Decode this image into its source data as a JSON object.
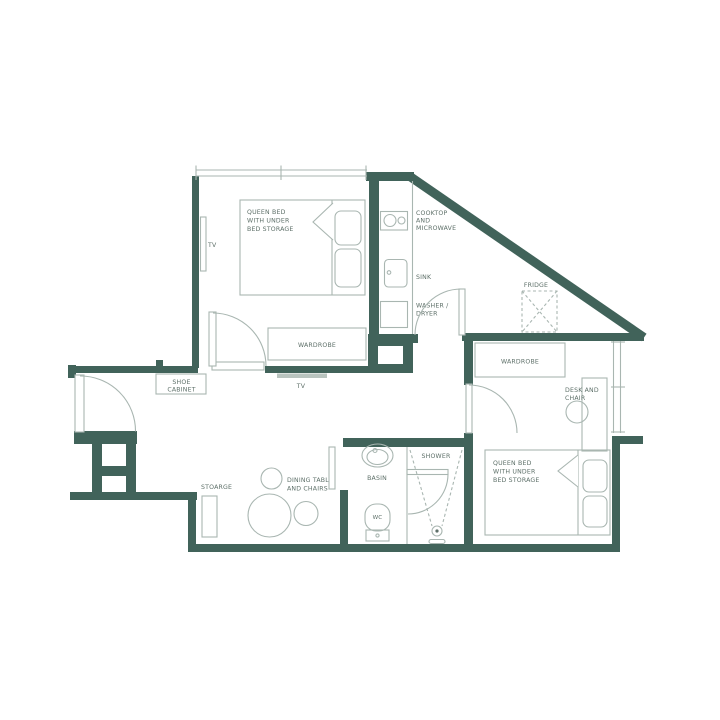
{
  "title": "Apartment floor plan",
  "colors": {
    "wall": "#41635a",
    "furniture_line": "#a9b6b1",
    "label_text": "#5d6f68",
    "background": "#ffffff"
  },
  "rooms": {
    "bedroom1": {
      "bed_lines": [
        "QUEEN BED",
        "WITH UNDER",
        "BED STORAGE"
      ],
      "tv": "TV",
      "wardrobe": "WARDROBE"
    },
    "hallway": {
      "shoe_cabinet_lines": [
        "SHOE",
        "CABINET"
      ],
      "tv": "TV"
    },
    "kitchen": {
      "cooktop_lines": [
        "COOKTOP",
        "AND",
        "MICROWAVE"
      ],
      "sink": "SINK",
      "washer_lines": [
        "WASHER /",
        "DRYER"
      ],
      "fridge": "FRIDGE"
    },
    "living": {
      "storage": "STOARGE",
      "dining_lines": [
        "DINING TABLE",
        "AND CHAIRS"
      ]
    },
    "bathroom": {
      "basin": "BASIN",
      "wc": "WC",
      "shower": "SHOWER"
    },
    "bedroom2": {
      "wardrobe": "WARDROBE",
      "desk_lines": [
        "DESK AND",
        "CHAIR"
      ],
      "bed_lines": [
        "QUEEN BED",
        "WITH UNDER",
        "BED STORAGE"
      ]
    }
  }
}
